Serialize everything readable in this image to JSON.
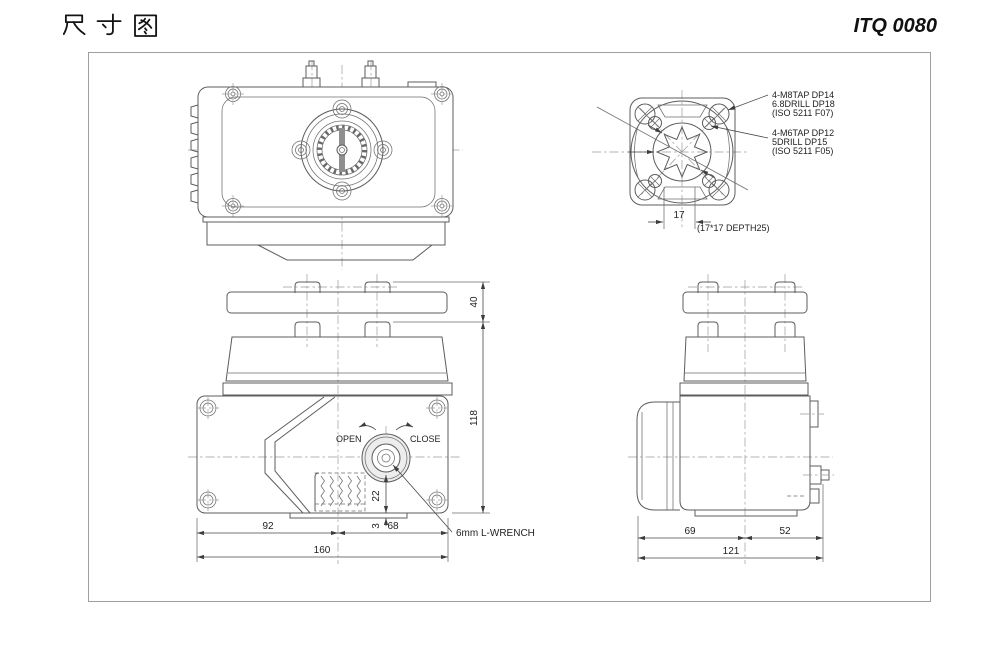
{
  "header": {
    "title": "尺寸图",
    "model": "ITQ 0080"
  },
  "flange": {
    "notes_f07": [
      "4-M8TAP DP14",
      "6.8DRILL DP18",
      "(ISO 5211 F07)"
    ],
    "notes_f05": [
      "4-M6TAP DP12",
      "5DRILL DP15",
      "(ISO 5211 F05)"
    ],
    "dim_square": "17",
    "depth_note": "(17*17 DEPTH25)"
  },
  "front": {
    "open_label": "OPEN",
    "close_label": "CLOSE",
    "wrench_note": "6mm L-WRENCH",
    "dims": {
      "cap": "40",
      "body": "118",
      "shaft": "22",
      "base": "3",
      "left": "92",
      "right": "68",
      "total": "160"
    }
  },
  "side": {
    "dims": {
      "left": "69",
      "right": "52",
      "total": "121"
    }
  }
}
